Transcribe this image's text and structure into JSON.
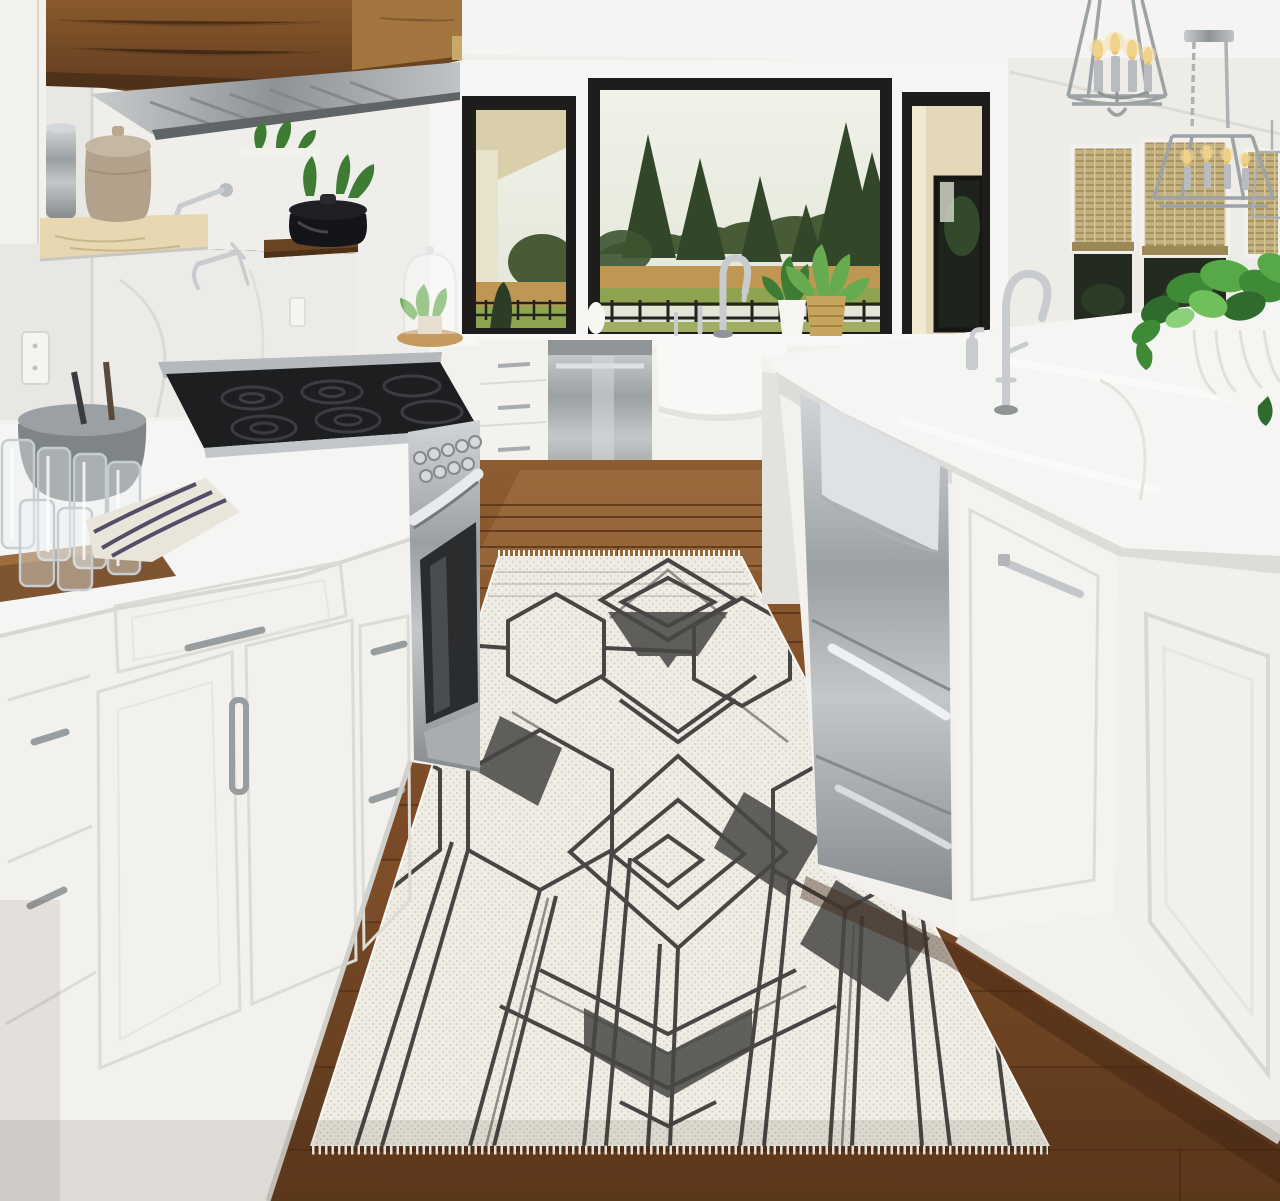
{
  "scene": {
    "type": "photograph",
    "setting": "bright white farmhouse kitchen interior",
    "subject": "ivory runner rug with charcoal geometric hexagon, diamond and chevron pattern",
    "description": "Bright white farmhouse kitchen with a walnut hood cabinet over a stainless gas range, black-framed windows looking onto evergreen trees and a golden field with an iron fence, a marble-topped island with stainless farmhouse sink and chrome lantern pendants, trailing pothos in a ribbed white bowl, and an ivory geometric runner rug on warm hardwood flooring."
  },
  "objects": [
    {
      "id": "range-hood",
      "label": "walnut wood range hood cabinet with stainless vent"
    },
    {
      "id": "open-shelves",
      "label": "floating wood shelves with ceramic crock, canister and black dutch oven"
    },
    {
      "id": "pot-filler",
      "label": "chrome wall-mounted pot filler faucet"
    },
    {
      "id": "gas-range",
      "label": "stainless professional gas range with black grates"
    },
    {
      "id": "left-cabinets",
      "label": "white shaker cabinets with brushed nickel pulls"
    },
    {
      "id": "counter-props",
      "label": "wood tray with drinking glasses, gray mixing bowl and striped towel"
    },
    {
      "id": "glass-cloche",
      "label": "glass cloche with small plant"
    },
    {
      "id": "dishwasher",
      "label": "stainless dishwasher"
    },
    {
      "id": "farmhouse-sink",
      "label": "white apron farmhouse sink with gooseneck faucet"
    },
    {
      "id": "windows",
      "label": "black framed picture windows with evergreen and field view"
    },
    {
      "id": "bamboo-shades",
      "label": "woven bamboo roman shades"
    },
    {
      "id": "pendants",
      "label": "polished chrome lantern pendant lights with candle bulbs"
    },
    {
      "id": "island",
      "label": "marble-topped kitchen island with stainless drawers and paneled doors"
    },
    {
      "id": "island-faucet",
      "label": "chrome island prep faucet"
    },
    {
      "id": "pothos",
      "label": "trailing pothos plant in ribbed white bowl planter"
    },
    {
      "id": "runner-rug",
      "label": "ivory and charcoal geometric runner rug"
    },
    {
      "id": "wood-floor",
      "label": "warm brown hardwood plank floor"
    },
    {
      "id": "wall-outlet",
      "label": "white wall outlet"
    }
  ],
  "colors": {
    "ceiling": "#f5f4f2",
    "wall": "#efeeeb",
    "wall_left": "#e8e7e3",
    "wall_right": "#edece7",
    "wall_back": "#f6f5f3",
    "window_frame": "#1e1d1b",
    "sky": "#e9ebe2",
    "forest": "#475b37",
    "tree": "#32462a",
    "field": "#c09752",
    "lawn": "#8fa451",
    "fence": "#232321",
    "porch": "#d9cfab",
    "house": "#e3d9ba",
    "shade": "#c3b183",
    "pane": "#232a1f",
    "hood_wood": "#7c4f27",
    "hood_wood_light": "#a4763f",
    "steel": "#b5b9bb",
    "steel_dark": "#83888b",
    "cooktop": "#1d1e20",
    "cabinet": "#f2f1ee",
    "cabinet_shade": "#e3e2de",
    "marble": "#f5f5f3",
    "marble_edge": "#dddcd8",
    "floor": "#7c4c27",
    "floor_dark": "#5b371c",
    "floor_light": "#9a6a3c",
    "rug": "#efece4",
    "rug_fringe": "#f9f7f1",
    "rug_ink": "#474644",
    "rug_ink_soft": "#8d8c86",
    "chrome": "#c8ccce",
    "chrome_dark": "#8f9497",
    "plant": "#3e7c33",
    "plant_light": "#67ab51",
    "planter": "#f6f5f1",
    "basket": "#c7a45d",
    "pot_black": "#141518",
    "crock": "#b2a28c",
    "shelf_light": "#e7d8b2",
    "shelf_dark": "#6b4523",
    "tray": "#7e5530",
    "bowl_gray": "#7e8488",
    "towel": "#e9e5da",
    "towel_stripe": "#534d68",
    "bulb": "#ebc36d",
    "glass": "#c9d0d3",
    "vent": "#2c2d2f"
  }
}
